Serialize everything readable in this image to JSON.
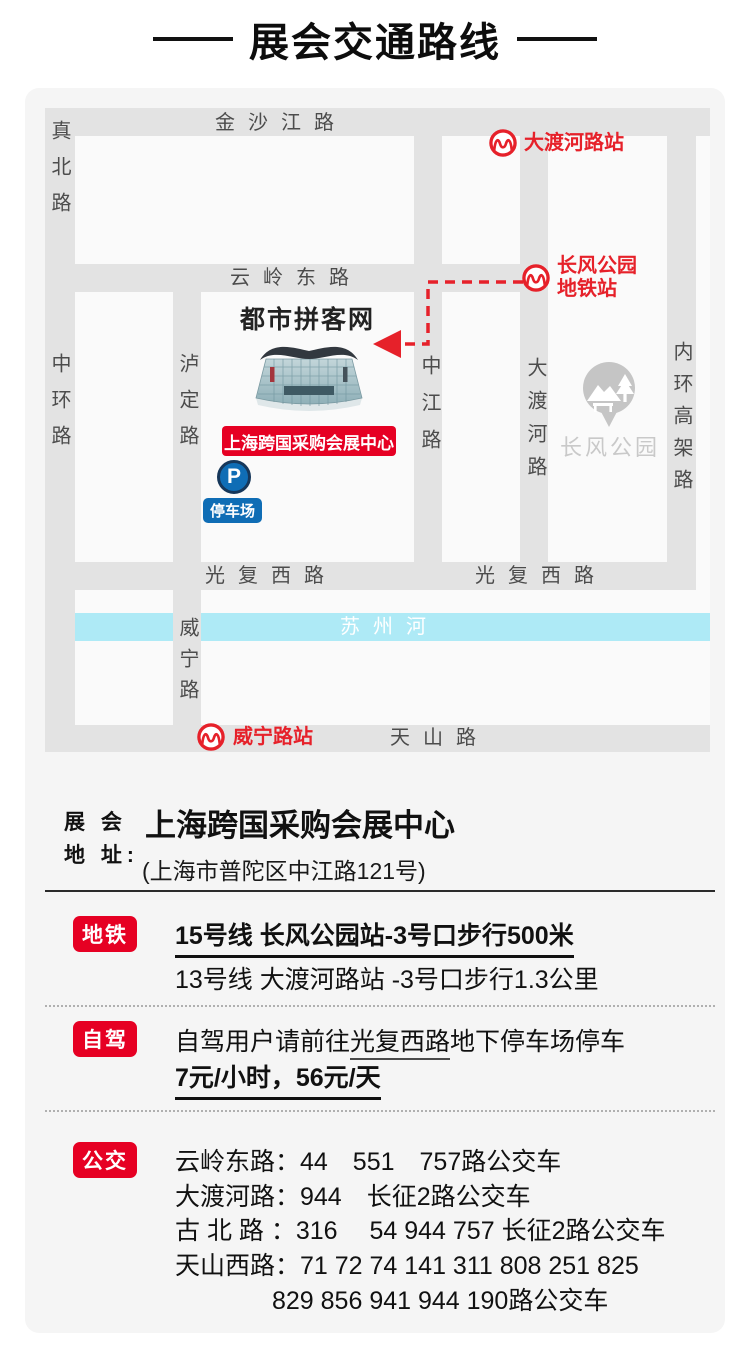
{
  "title": {
    "text": "展会交通路线"
  },
  "colors": {
    "accent_red": "#e6212a",
    "badge_red": "#e60023",
    "river_blue": "#aeeaf6",
    "parking_blue": "#0f6db5",
    "road_gray": "#e3e3e3",
    "panel_gray": "#f5f5f5"
  },
  "map": {
    "roads": {
      "jinshajiang": "金沙江路",
      "zhenbei": "真北路",
      "yunling": "云岭东路",
      "zhonghuan": "中环路",
      "luding": "泸定路",
      "zhongjiang": "中江路",
      "daduhe": "大渡河路",
      "neihuan": "内环高架路",
      "guangfu_left": "光复西路",
      "guangfu_right": "光复西路",
      "weining": "威宁路",
      "tianshan": "天山路",
      "suzhou_river": "苏州河"
    },
    "stations": {
      "daduhe": "大渡河路站",
      "changfeng_line1": "长风公园",
      "changfeng_line2": "地铁站",
      "weining": "威宁路站"
    },
    "landmarks": {
      "site_name": "都市拼客网",
      "venue_label": "上海跨国采购会展中心",
      "park": "长风公园",
      "parking_letter": "P",
      "parking_tag": "停车场"
    }
  },
  "address": {
    "label_line1": "展 会",
    "label_line2": "地 址:",
    "venue": "上海跨国采购会展中心",
    "detail": "(上海市普陀区中江路121号)"
  },
  "sections": {
    "metro": {
      "badge": "地铁",
      "line1": "15号线 长风公园站-3号口步行500米",
      "line2": "13号线 大渡河路站 -3号口步行1.3公里"
    },
    "driving": {
      "badge": "自驾",
      "line1_pre": "自驾用户请前往",
      "line1_road": "光复西路",
      "line1_post": "地下停车场停车",
      "line2": "7元/小时，56元/天"
    },
    "bus": {
      "badge": "公交",
      "lines": [
        "云岭东路：44　551　757路公交车",
        "大渡河路：944　长征2路公交车",
        "古 北 路 ：316　 54  944  757  长征2路公交车",
        "天山西路：71 72 74 141 311 808 251 825",
        "829  856  941  944  190路公交车"
      ]
    }
  }
}
